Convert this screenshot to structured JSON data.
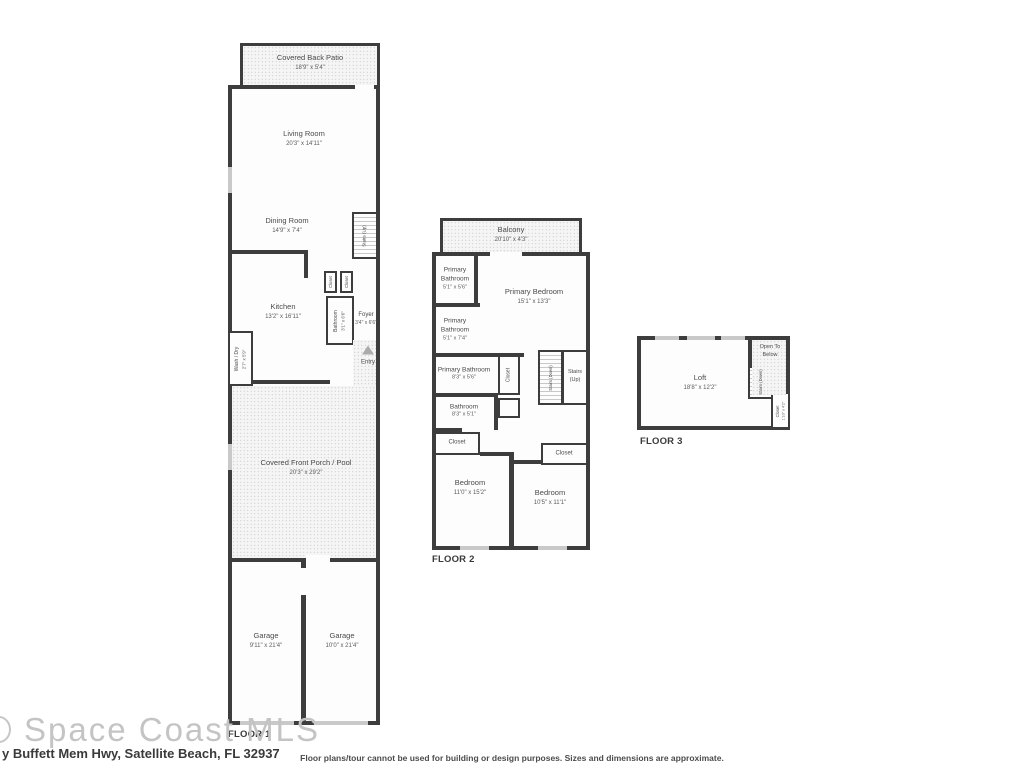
{
  "footer": {
    "watermark": "Space Coast MLS",
    "address": "y Buffett Mem Hwy, Satellite Beach, FL 32937",
    "disclaimer": "Floor plans/tour cannot be used for building or design purposes. Sizes and dimensions are approximate."
  },
  "floor1": {
    "label": "FLOOR 1",
    "covered_back_patio": {
      "name": "Covered Back Patio",
      "dims": "18'9\" x 5'4\""
    },
    "living_room": {
      "name": "Living Room",
      "dims": "20'3\" x 14'11\""
    },
    "dining_room": {
      "name": "Dining Room",
      "dims": "14'9\" x 7'4\""
    },
    "stairs_up": {
      "name": "Stairs (Up)"
    },
    "kitchen": {
      "name": "Kitchen",
      "dims": "13'2\" x 16'11\""
    },
    "closet_a": {
      "name": "Closet"
    },
    "closet_b": {
      "name": "Closet"
    },
    "bathroom": {
      "name": "Bathroom",
      "dims": "3'1\" x 6'6\""
    },
    "foyer": {
      "name": "Foyer",
      "dims": "3'4\" x 6'6\""
    },
    "wash_dry": {
      "name": "Wash / Dry",
      "dims": "2'7\" x 5'9\""
    },
    "entry": {
      "name": "Entry"
    },
    "covered_front_porch": {
      "name": "Covered Front Porch / Pool",
      "dims": "20'3\" x 29'2\""
    },
    "garage_left": {
      "name": "Garage",
      "dims": "9'11\" x 21'4\""
    },
    "garage_right": {
      "name": "Garage",
      "dims": "10'0\" x 21'4\""
    }
  },
  "floor2": {
    "label": "FLOOR 2",
    "balcony": {
      "name": "Balcony",
      "dims": "20'10\" x 4'3\""
    },
    "primary_bathroom_a": {
      "name": "Primary Bathroom",
      "dims": "5'1\" x 5'6\""
    },
    "primary_bathroom_b": {
      "name": "Primary Bathroom",
      "dims": "5'1\" x 7'4\""
    },
    "primary_bedroom": {
      "name": "Primary Bedroom",
      "dims": "15'1\" x 13'3\""
    },
    "primary_bathroom_c": {
      "name": "Primary Bathroom",
      "dims": "8'3\" x 5'6\""
    },
    "closet_hall": {
      "name": "Closet"
    },
    "stairs_down": {
      "name": "Stairs (Down)"
    },
    "stairs_up": {
      "name": "Stairs (Up)"
    },
    "bathroom": {
      "name": "Bathroom",
      "dims": "8'3\" x 5'1\""
    },
    "closet_left": {
      "name": "Closet"
    },
    "closet_right": {
      "name": "Closet"
    },
    "bedroom_left": {
      "name": "Bedroom",
      "dims": "11'0\" x 15'2\""
    },
    "bedroom_right": {
      "name": "Bedroom",
      "dims": "10'5\" x 11'1\""
    }
  },
  "floor3": {
    "label": "FLOOR 3",
    "loft": {
      "name": "Loft",
      "dims": "18'8\" x 12'2\""
    },
    "open_to_below": {
      "name": "Open To Below"
    },
    "stairs_down": {
      "name": "Stairs (Down)"
    },
    "closet": {
      "name": "Closet",
      "dims": "1'10\" x 4'2\""
    }
  }
}
